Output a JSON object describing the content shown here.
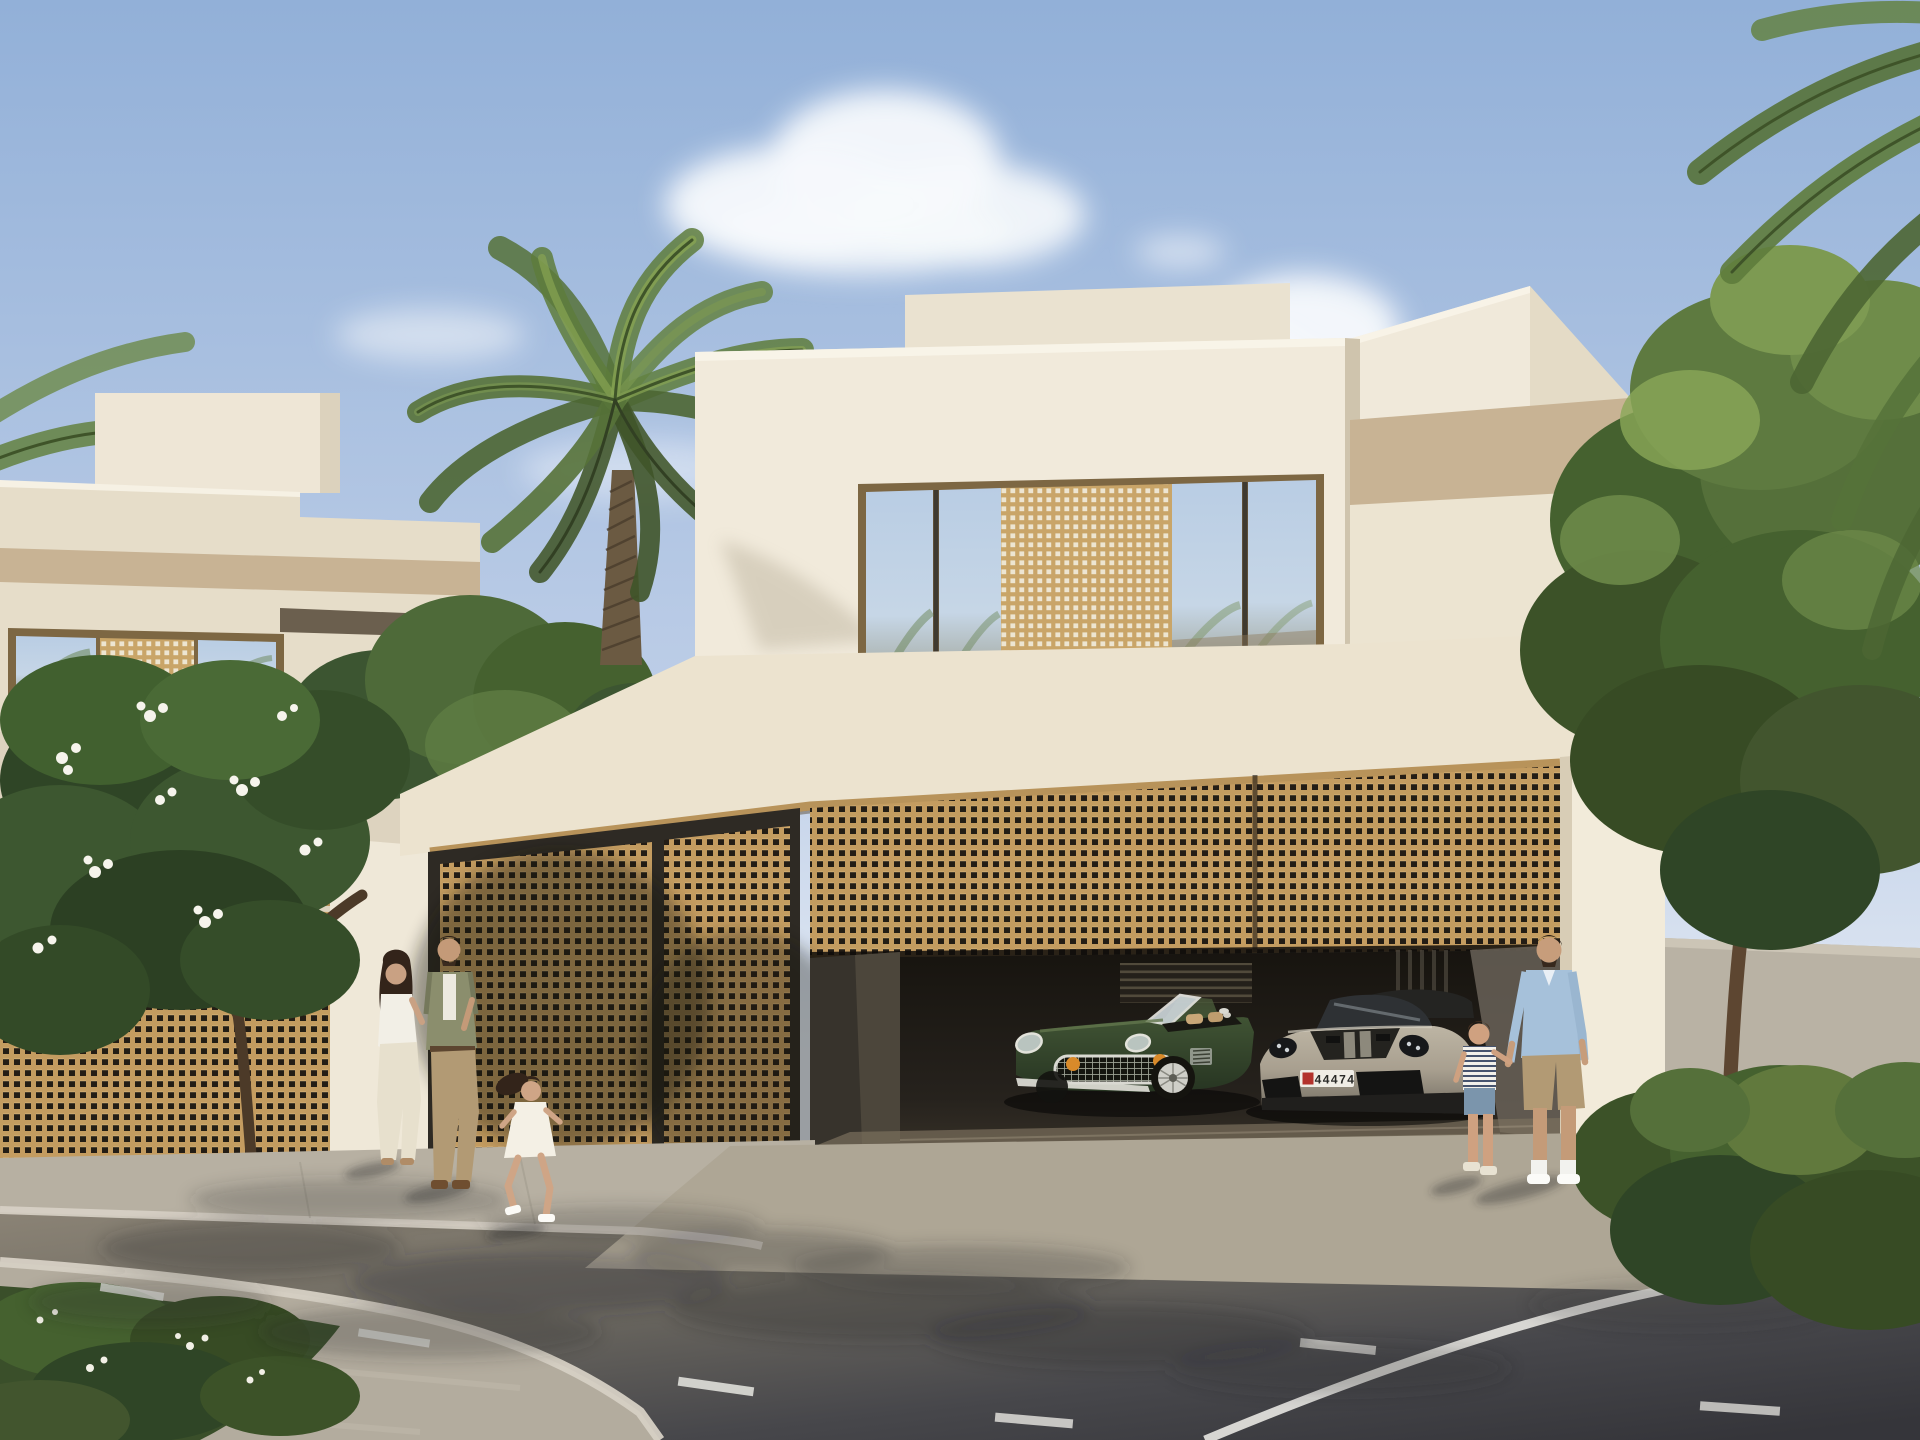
{
  "scene": {
    "type": "architectural exterior rendering",
    "setting": "Modern white villas with gold mashrabiya lattice screens, date palm and frangipani trees, an open street-level garage with two sports cars, and a family walking on the sidewalk",
    "time_of_day": "late afternoon, sun from the right",
    "license_plate": {
      "number": "44474",
      "badge": "red emblem square on left of plate"
    }
  },
  "palette": {
    "sky_top": "#92b0d8",
    "sky_mid": "#bccde7",
    "sky_horizon": "#e2e9f3",
    "cloud": "#f7f9fc",
    "wall_cream_lit": "#f1eadb",
    "wall_cream_shade": "#e2d8c4",
    "wall_rear": "#eae2d0",
    "parapet_tan": "#c8b394",
    "fascia_cream": "#ece3cf",
    "bronze_frame": "#7d6743",
    "gold_lattice": "#c49c60",
    "lattice_hole": "#241d15",
    "lattice_light_hole": "#ede5d1",
    "gold_rail": "#b8935a",
    "garage_dark": "#17140f",
    "garage_floor": "#6f6454",
    "glass_sky": "#b9cde4",
    "glass_warm": "#8d7a5c",
    "car_green": "#3f5233",
    "car_green_dark": "#273522",
    "chrome": "#d9d9d2",
    "amber_lamp": "#d98a2a",
    "porsche_body": "#a89f8f",
    "porsche_dark": "#201f1d",
    "plate_white": "#f0ede6",
    "plate_red": "#b3322c",
    "plate_text": "#2a2a28",
    "road_lit": "#8d8577",
    "road_dark": "#35353a",
    "lane_marking": "#e8e7e2",
    "sidewalk": "#b7b0a2",
    "sidewalk_sun": "#c3bcac",
    "apron": "#aea695",
    "island_pavement": "#b3ac9e",
    "curb": "#d8d2c6",
    "foliage_dark": "#2f4526",
    "foliage_mid": "#45612f",
    "foliage_light": "#6f8c4a",
    "foliage_sun": "#8aa858",
    "palm_green": "#5e7c3c",
    "palm_rib": "#3f5429",
    "trunk_brown": "#6b5a42",
    "flower_white": "#f6f4ec",
    "skin": "#c9a183",
    "hair_dark": "#33241a",
    "shirt_olive": "#8b8e6d",
    "shirt_blue": "#a6c1da",
    "khaki": "#b29a74",
    "denim": "#7b95ac",
    "white_cloth": "#f2efe6"
  },
  "objects": {
    "villa_left": {
      "name": "neighbouring villa",
      "features": [
        "stepped rooftop volume",
        "bronze framed window with lattice insert",
        "gold mashrabiya fence",
        "dark slatted pedestrian gate"
      ]
    },
    "villa_main": {
      "name": "main villa",
      "features": [
        "stepped white volumes",
        "tan parapet band",
        "narrow slit window",
        "bronze framed upper window with sliding lattice panel",
        "gold mashrabiya garage screen",
        "open double garage"
      ]
    },
    "garage": {
      "cars": [
        {
          "type": "classic green roadster",
          "details": "chrome egg-crate grille, amber lamps, wire wheels, tan interior"
        },
        {
          "type": "grey sports car",
          "details": "black hood with stripes, black intakes, front plate 44474"
        }
      ]
    },
    "people": [
      {
        "role": "woman",
        "outfit": "white blouse, cream wide trousers"
      },
      {
        "role": "man",
        "outfit": "olive overshirt, white tee, khaki chinos"
      },
      {
        "role": "girl",
        "outfit": "white dress, running"
      },
      {
        "role": "father",
        "outfit": "light blue shirt, khaki shorts, white socks and sneakers"
      },
      {
        "role": "boy",
        "outfit": "striped tee, denim shorts"
      }
    ],
    "vegetation": [
      "date palm",
      "frangipani tree with white flowers",
      "large ficus tree",
      "clipped hedges",
      "planted street island"
    ],
    "street": {
      "markings": [
        "white dashed centre line",
        "white solid edge line"
      ],
      "surfaces": [
        "asphalt road",
        "concrete sidewalk",
        "driveway apron",
        "kerbed planting island"
      ]
    }
  }
}
